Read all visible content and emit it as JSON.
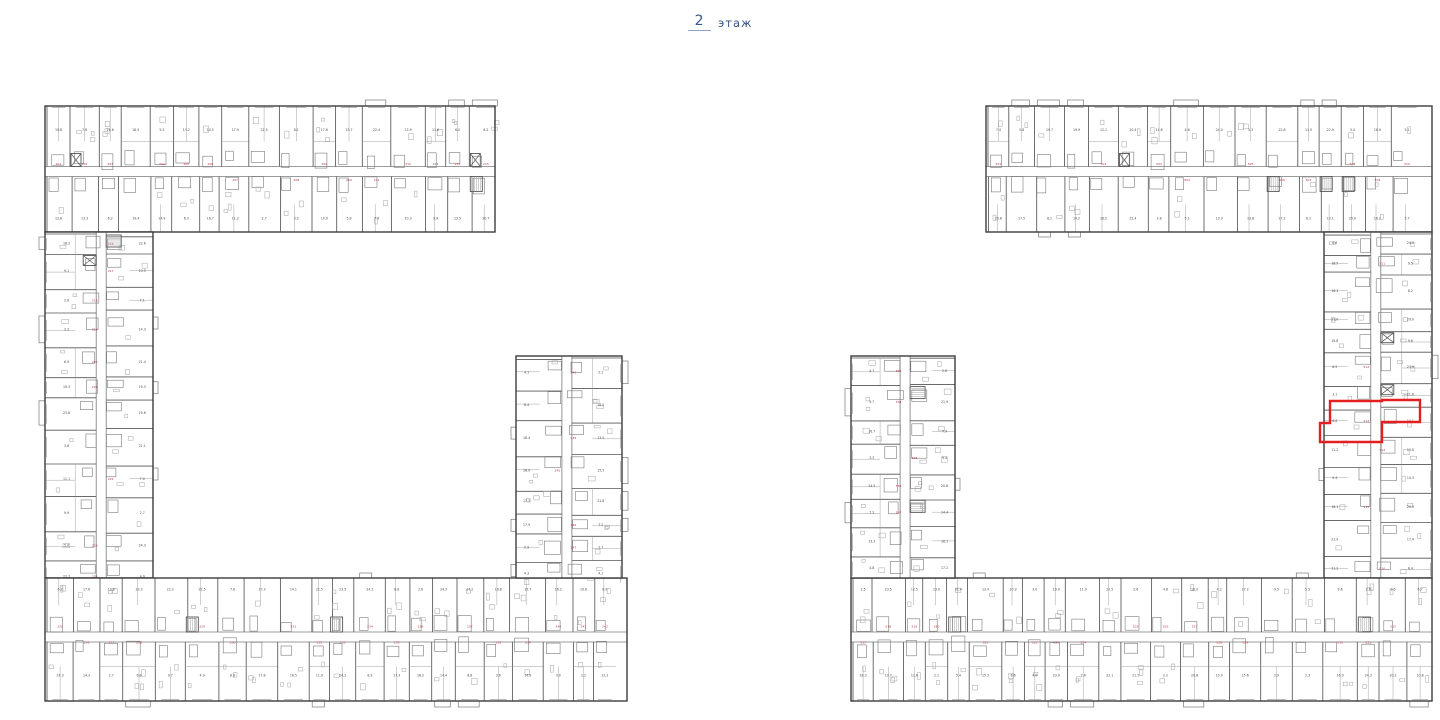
{
  "header": {
    "floor_number": "2",
    "floor_label": "этаж"
  },
  "floorplan": {
    "seed": 911,
    "canvas": {
      "width": 1440,
      "height": 720
    },
    "colors": {
      "background": "#ffffff",
      "wall": "#3c3c3c",
      "wall2": "#555555",
      "partition": "#7a7a7a",
      "light": "#a3a3a3",
      "text": "#4a4a4a",
      "unit_number": "#b5353b",
      "highlight": "#e3201f",
      "title_blue": "#35568e"
    },
    "texture": {
      "module_min": 20,
      "module_max": 36,
      "corridor_halfwidth": 5,
      "balcony_depth": 6,
      "area_label_min": 2.0,
      "area_label_max": 24.5
    },
    "buildings": [
      {
        "id": "left",
        "unit_number_start": 201,
        "wings": [
          {
            "id": "top",
            "x": 45,
            "y": 106,
            "w": 450,
            "h": 126,
            "dir": "h",
            "outer": "min"
          },
          {
            "id": "left",
            "x": 45,
            "y": 232,
            "w": 108,
            "h": 346,
            "dir": "v",
            "outer": "min"
          },
          {
            "id": "bottom",
            "x": 45,
            "y": 578,
            "w": 582,
            "h": 123,
            "dir": "h",
            "outer": "max"
          },
          {
            "id": "right-stub",
            "x": 516,
            "y": 356,
            "w": 106,
            "h": 222,
            "dir": "v",
            "outer": "max"
          }
        ]
      },
      {
        "id": "right",
        "unit_number_start": 501,
        "wings": [
          {
            "id": "top",
            "x": 986,
            "y": 106,
            "w": 446,
            "h": 126,
            "dir": "h",
            "outer": "min"
          },
          {
            "id": "right",
            "x": 1324,
            "y": 232,
            "w": 108,
            "h": 346,
            "dir": "v",
            "outer": "max"
          },
          {
            "id": "bottom",
            "x": 851,
            "y": 578,
            "w": 581,
            "h": 123,
            "dir": "h",
            "outer": "max"
          },
          {
            "id": "left-stub",
            "x": 851,
            "y": 356,
            "w": 104,
            "h": 222,
            "dir": "v",
            "outer": "min"
          }
        ],
        "highlight": {
          "path": "M1330,401 L1382,401 L1382,400 L1420,400 L1420,422 L1382,422 L1382,442 L1320,442 L1320,423 L1330,423 Z"
        }
      }
    ]
  }
}
